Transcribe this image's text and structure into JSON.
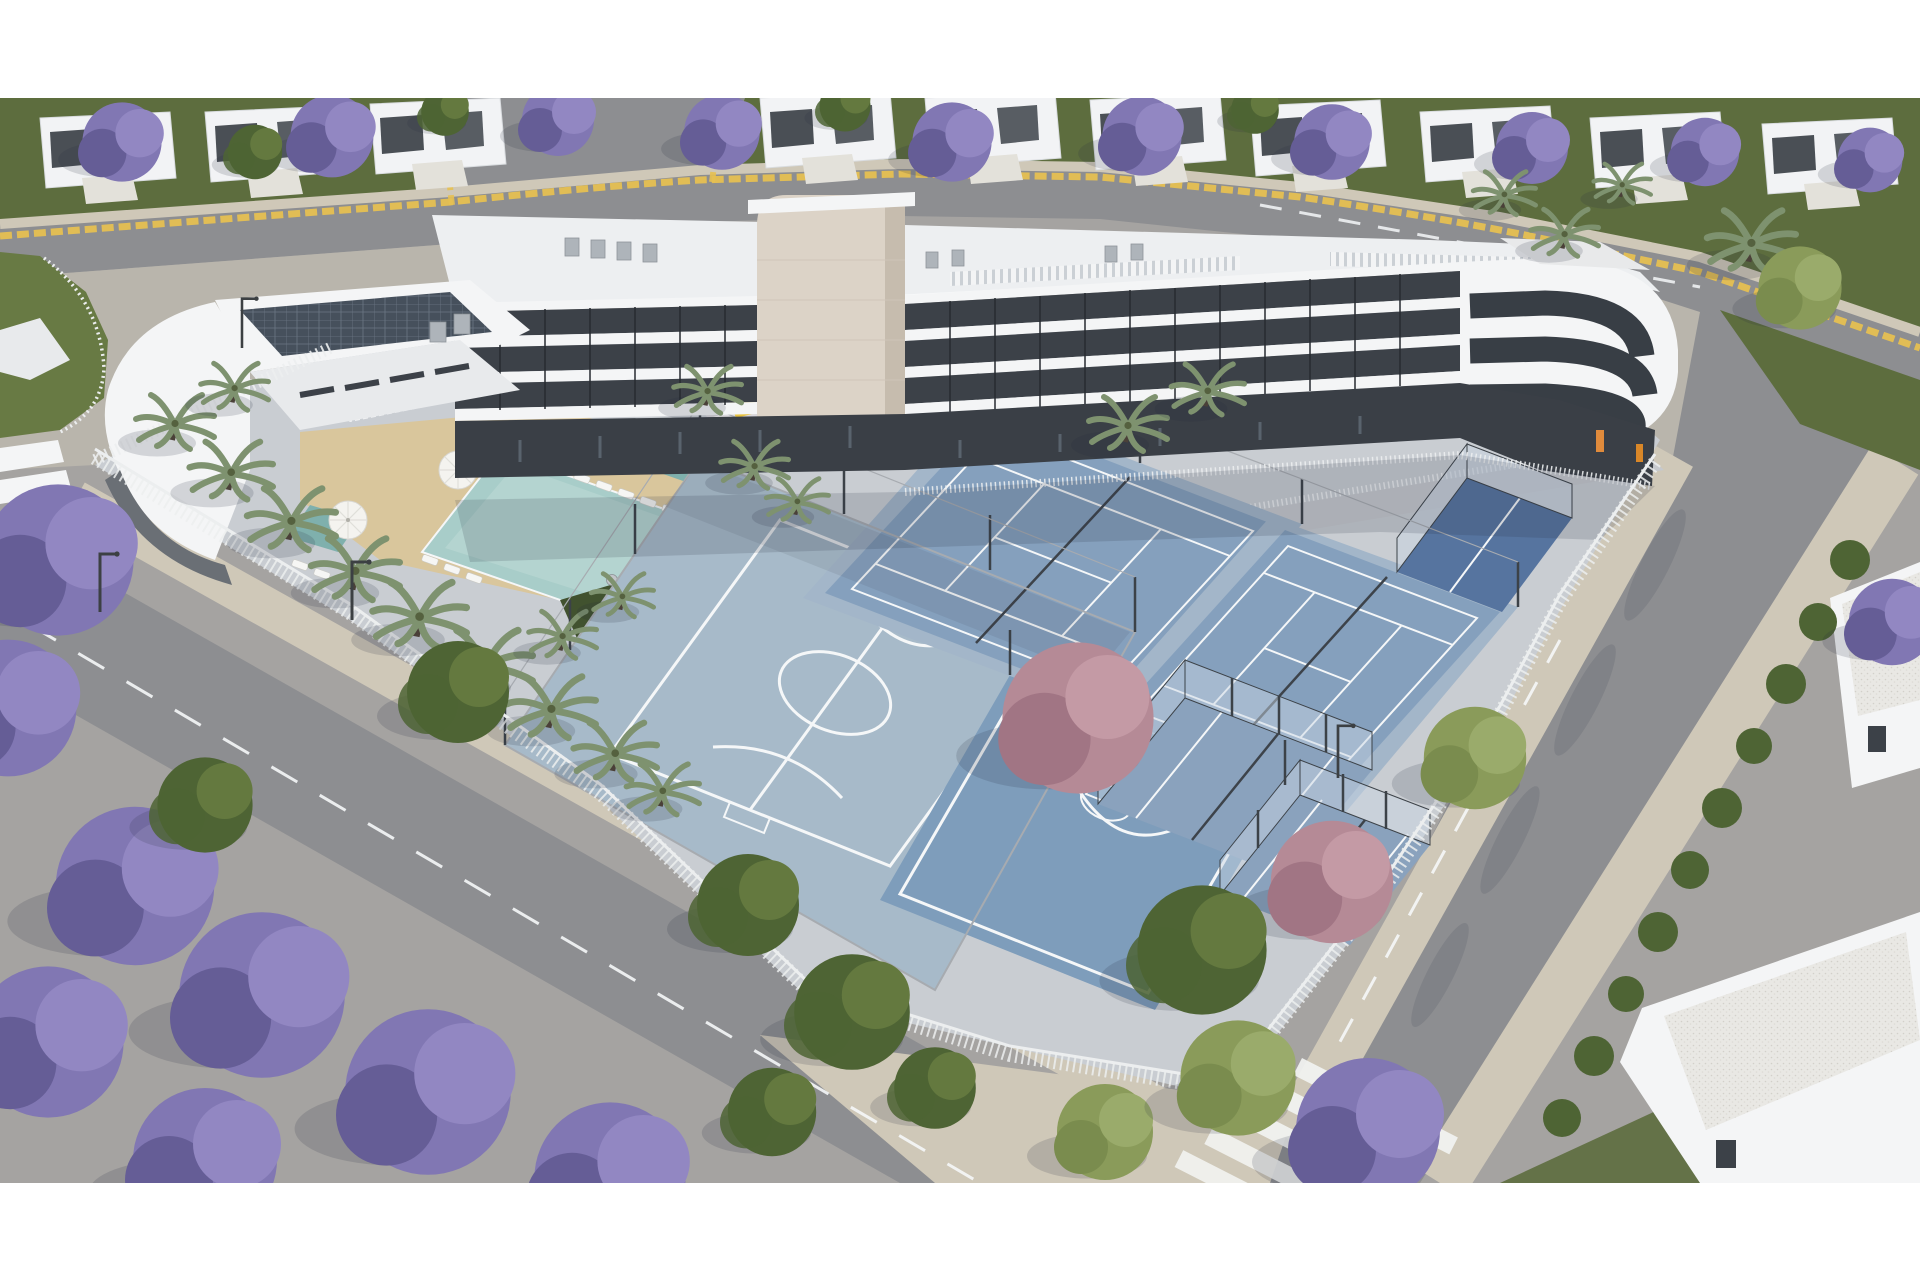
{
  "scene": {
    "type": "architectural-aerial-3d-render",
    "subject": "residential-apartment-complex-with-sports-courts-and-pool",
    "canvas": {
      "width": 1920,
      "height": 1280
    },
    "letterbox_top_px": 98,
    "letterbox_bottom_px": 97
  },
  "colors": {
    "letterbox": "#ffffff",
    "ground_base": "#a5a3a1",
    "road": "#8d8e91",
    "plaza": "#b9b5ac",
    "sidewalk": "#cfc8b8",
    "grass": "#5d6d3e",
    "lawn": "#687a44",
    "garden_green": "#41522f",
    "tree_green": "#4e6434",
    "tree_light": "#8a9b5a",
    "jacaranda": "#8177b3",
    "jacaranda_dark": "#655d96",
    "jacaranda_light": "#9287c2",
    "pink_tree": "#b58a96",
    "pink_dark": "#a17584",
    "palm": "#7e926f",
    "trunk": "#4a4038",
    "building_white": "#f4f5f6",
    "building_mid": "#e8eaec",
    "roof_white": "#edeff1",
    "window_dark": "#3c4148",
    "glass_dark": "#2e3338",
    "stone_tower": "#dcd3c7",
    "stone_shade": "#c6bcae",
    "solar_panel": "#46505c",
    "pool_water": "#a8cdc9",
    "pool_deep": "#7fb0ad",
    "sand_deck": "#d9c69c",
    "court_futsal": "#a7bac9",
    "court_basket": "#7e9dbb",
    "court_tennis": "#85a0bd",
    "court_tennis_border": "#a3b6c9",
    "court_dark_blue": "#56749f",
    "court_padel": "#8aa2bd",
    "padel_glass": "rgba(200,214,228,0.48)",
    "line_white": "#f5f7f8",
    "fence_white": "#eceeef",
    "fence_gray": "#a7abb0",
    "post_dark": "#3c4248",
    "curb_yellow": "#e6c052",
    "gravel_roof": "#e9e8e4",
    "orange_equipment": "#e08b3c",
    "yellow_slide": "#e8c23f",
    "umbrella_white": "#f4f3ef",
    "ac_gray": "#aeb4ba",
    "table_gray": "#c2c5c9",
    "lamp_pole": "#3c4043",
    "shadow": "rgba(40,45,60,0.16)",
    "dark_base": "#3a3f46",
    "ramp_gray": "#c6c9cd",
    "hoop_red": "#c0392b"
  },
  "elements": {
    "buildings": [
      "apartment-block",
      "stone-elevator-tower",
      "rounded-corner-wing",
      "clubhouse-with-solar-roof",
      "neighbor-townhouses",
      "neighbor-flat-roof-buildings"
    ],
    "amenities": [
      "swimming-pool",
      "kids-pool",
      "sun-loungers",
      "pool-umbrellas",
      "garden-terrace-tables",
      "children-playground",
      "calisthenics-area",
      "sand-deck"
    ],
    "sports": [
      "futsal-court",
      "basketball-half-court",
      "tennis-court-1",
      "tennis-court-2",
      "padel-court-1",
      "padel-court-2",
      "dark-blue-padel-court"
    ],
    "circulation": [
      "top-road",
      "right-road",
      "left-road",
      "branch-road",
      "zebra-crosswalk",
      "mini-crosswalk",
      "yellow-curb-line",
      "roundabout-lawn",
      "plaza",
      "sidewalks",
      "access-ramp"
    ],
    "vegetation": [
      "jacaranda-trees",
      "green-trees",
      "light-green-trees",
      "pink-blossom-trees",
      "palm-trees",
      "roadside-hedge",
      "lawns"
    ]
  }
}
